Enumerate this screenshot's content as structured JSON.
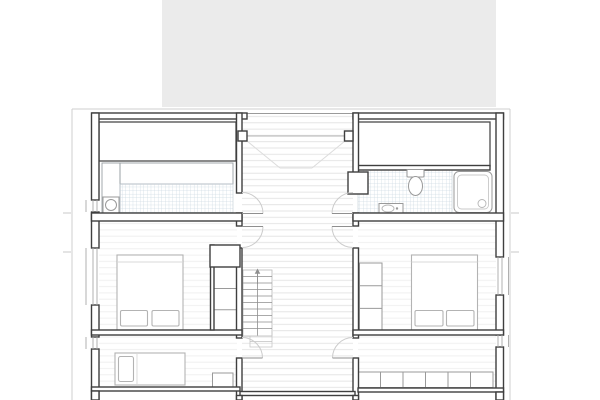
{
  "meta": {
    "title": "Architectural floor plan, upper storey (cropped sheet, no text labels visible)",
    "drawing_type": "floor-plan"
  },
  "palette": {
    "background": "#ffffff",
    "upper_volume": "#ebebeb",
    "wall": "#3f3f3f",
    "wall_medium": "#4a4a4a",
    "fixture": "#9a9a9a",
    "furniture": "#b3b3b3",
    "floor_line_hall": "#e2e2e2",
    "floor_line_room": "#eeeeee",
    "tile": "#ccd9e2",
    "facade": "#cfcfcf",
    "door_arc": "#cccccc",
    "door_leaf": "#8f8f8f",
    "stair": "#8f8f8f",
    "roof_line": "#dcdcdc",
    "glazing": "#a8a8a8",
    "tick": "#c8c8c8"
  },
  "plan": {
    "upper_volume_block": "grey roof/upper-level mass at top of sheet",
    "rooms": [
      {
        "name": "sauna",
        "position": "top-left",
        "features": [
          "storage-band",
          "bench-hatch",
          "tiled-floor",
          "sauna-heater"
        ]
      },
      {
        "name": "bathroom",
        "position": "top-right",
        "features": [
          "storage-band",
          "tiled-floor",
          "toilet",
          "washbasin",
          "shower"
        ]
      },
      {
        "name": "bedroom-left",
        "position": "middle-left",
        "features": [
          "double-bed",
          "two-pillows",
          "wardrobe-3-sections",
          "duct-shaft"
        ]
      },
      {
        "name": "bedroom-right",
        "position": "middle-right",
        "features": [
          "double-bed",
          "two-pillows",
          "wardrobe-3-sections"
        ]
      },
      {
        "name": "room-bottom-left",
        "position": "bottom-left",
        "features": [
          "single-bed",
          "pillow",
          "nightstand"
        ]
      },
      {
        "name": "room-bottom-right",
        "position": "bottom-right",
        "features": [
          "wardrobe-6-sections"
        ]
      },
      {
        "name": "hallway",
        "position": "center",
        "features": [
          "plank-floor",
          "six-door-swings",
          "roof-slope-lines"
        ]
      },
      {
        "name": "staircase",
        "position": "center-bottom",
        "features": [
          "treads",
          "center-rail-line",
          "up-arrow"
        ]
      }
    ],
    "door_count": 6,
    "window_gap_count": 5
  }
}
